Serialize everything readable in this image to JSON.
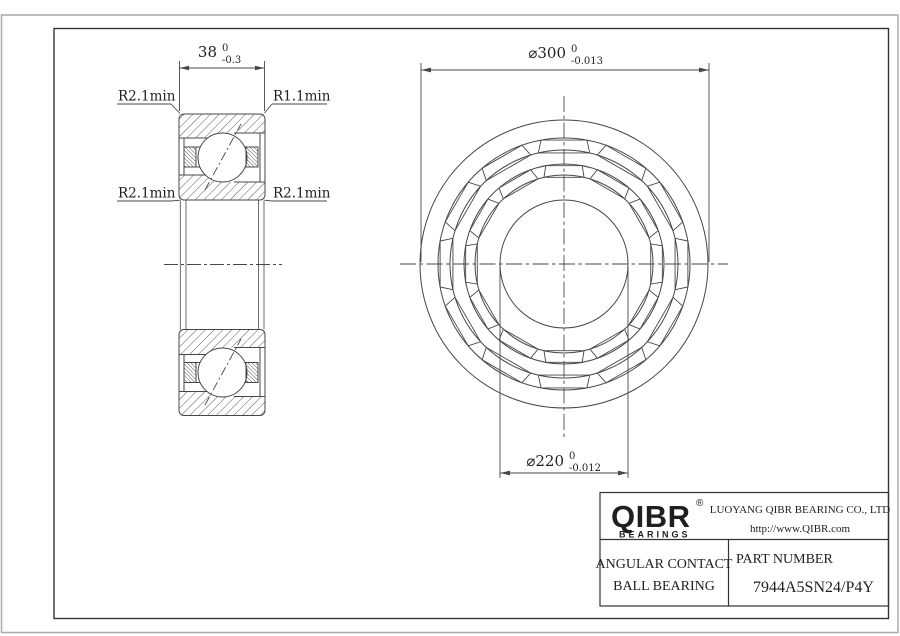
{
  "colors": {
    "line": "#474747",
    "border": "#333333",
    "sheet_edge": "#aaaaaa",
    "text": "#1f1f1f"
  },
  "view_labels": {
    "fillet_top_left": "R2.1min",
    "fillet_top_right": "R1.1min",
    "fillet_bottom_left": "R2.1min",
    "fillet_bottom_right": "R2.1min"
  },
  "dimensions": {
    "width": {
      "value": "38",
      "tol_upper": "0",
      "tol_lower": "-0.3"
    },
    "outer_diameter": {
      "value": "⌀300",
      "tol_upper": "0",
      "tol_lower": "-0.013"
    },
    "bore_diameter": {
      "value": "⌀220",
      "tol_upper": "0",
      "tol_lower": "-0.012"
    }
  },
  "title_block": {
    "logo_text": "QIBR",
    "logo_registered": "®",
    "logo_subtext": "BEARINGS",
    "company": "LUOYANG QIBR BEARING CO., LTD",
    "website": "http://www.QIBR.com",
    "product_line1": "ANGULAR CONTACT",
    "product_line2": "BALL BEARING",
    "part_number_label": "PART NUMBER",
    "part_number": "7944A5SN24/P4Y"
  }
}
